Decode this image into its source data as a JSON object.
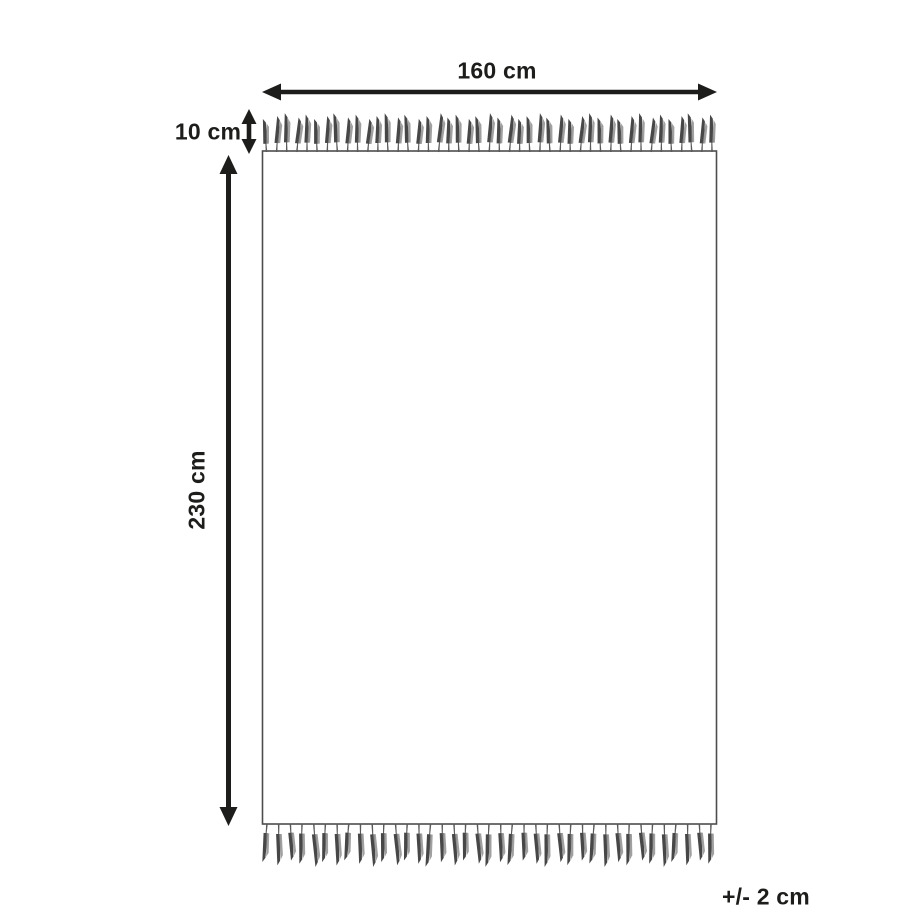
{
  "page": {
    "background": "#ffffff"
  },
  "diagram": {
    "name": "rug-dimensions-diagram",
    "labels": {
      "width": "160 cm",
      "fringe_height": "10 cm",
      "height": "230 cm",
      "tolerance": "+/- 2 cm"
    },
    "colors": {
      "ink": "#1d1d1b",
      "rug_outline": "#4d4d4d",
      "tassel_dark": "#474747",
      "tassel_light": "#8f8f8f",
      "tassel_stem": "#5a5a5a"
    },
    "fringe": {
      "top_tassel_count": 45,
      "bottom_tassel_count": 39
    }
  }
}
